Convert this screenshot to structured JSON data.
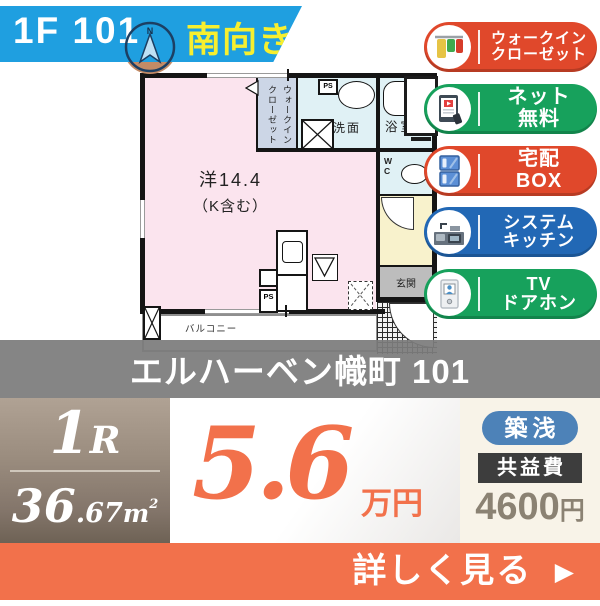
{
  "banner": {
    "unit": "1F 101",
    "direction": "南向き",
    "compass": "N"
  },
  "floorplan": {
    "room_label_line1": "洋14.4",
    "room_label_line2": "（K含む）",
    "wic_line1": "ウォークイン",
    "wic_line2": "クローゼット",
    "washroom": "洗面",
    "bathroom": "浴室",
    "wc": "WC",
    "entrance": "玄関",
    "balcony": "バルコニー",
    "ps": "PS",
    "ps2": "PS"
  },
  "features": [
    {
      "line1": "ウォークイン",
      "line2": "クローゼット",
      "color": "#e0482b",
      "icon": "closet-icon"
    },
    {
      "line1": "ネット",
      "line2": "無料",
      "color": "#17a15c",
      "icon": "internet-icon"
    },
    {
      "line1": "宅配",
      "line2": "BOX",
      "color": "#e0482b",
      "icon": "delivery-box-icon"
    },
    {
      "line1": "システム",
      "line2": "キッチン",
      "color": "#2268b5",
      "icon": "kitchen-icon"
    },
    {
      "line1": "TV",
      "line2": "ドアホン",
      "color": "#17a15c",
      "icon": "doorphone-icon"
    }
  ],
  "title": "エルハーベン幟町 101",
  "summary": {
    "layout_big": "1",
    "layout_small": "R",
    "area_int": "36",
    "area_dec": ".67",
    "area_unit_base": "m",
    "area_unit_sup": "2",
    "price_value": "5.6",
    "price_unit": "万円",
    "badge_age": "築浅",
    "fee_label": "共益費",
    "fee_value": "4600",
    "fee_unit": "円"
  },
  "cta": {
    "label": "詳しく見る",
    "arrow": "▶"
  },
  "colors": {
    "banner_blue": "#1f9fe0",
    "direction_yellow": "#f7ef2f",
    "accent_orange": "#f2714b",
    "badge_red": "#e0482b",
    "badge_green": "#17a15c",
    "badge_blue": "#2268b5",
    "age_badge_blue": "#4d82b8",
    "fee_badge_dark": "#3d3d3d",
    "main_room_pink": "#fbe4ee",
    "wet_area_blue": "#e0f1f5"
  }
}
